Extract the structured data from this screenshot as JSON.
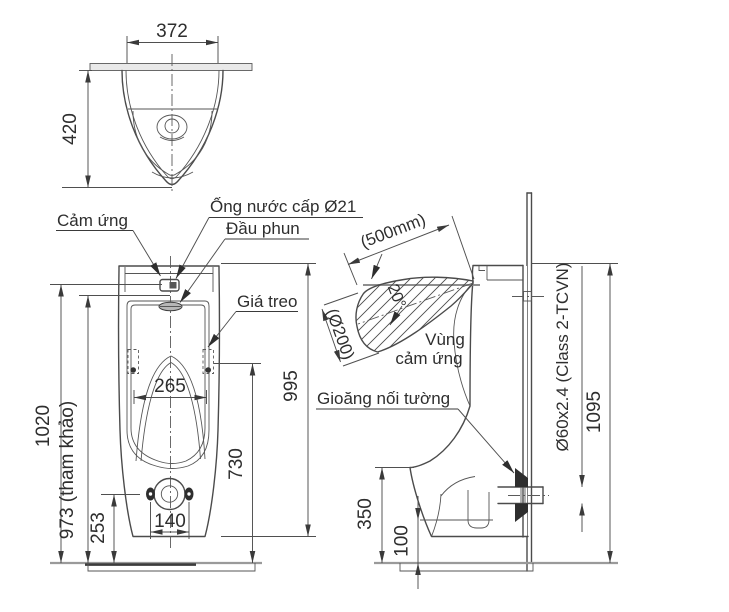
{
  "top_view": {
    "width": "372",
    "depth": "420"
  },
  "front_view": {
    "sensor_label": "Cảm ứng",
    "supply_label": "Ống nước cấp Ø21",
    "spray_label": "Đầu phun",
    "hanger_label": "Giá treo",
    "dim_total_height": "1020",
    "dim_ref_height": "973 (tham khảo)",
    "dim_drain_height": "253",
    "dim_bolt_spacing": "140",
    "dim_bowl_width": "265",
    "dim_hanger_height": "730",
    "dim_body_height": "995"
  },
  "side_view": {
    "sensor_zone_line1": "Vùng",
    "sensor_zone_line2": "cảm ứng",
    "gasket_label": "Gioăng nối tường",
    "dim_sensor_range": "(500mm)",
    "dim_sensor_angle": "20°",
    "dim_sensor_dia": "(Ø200)",
    "dim_pipe_spec": "Ø60x2.4 (Class 2-TCVN)",
    "dim_height": "1095",
    "dim_outlet_height": "350",
    "dim_base_height": "100"
  }
}
